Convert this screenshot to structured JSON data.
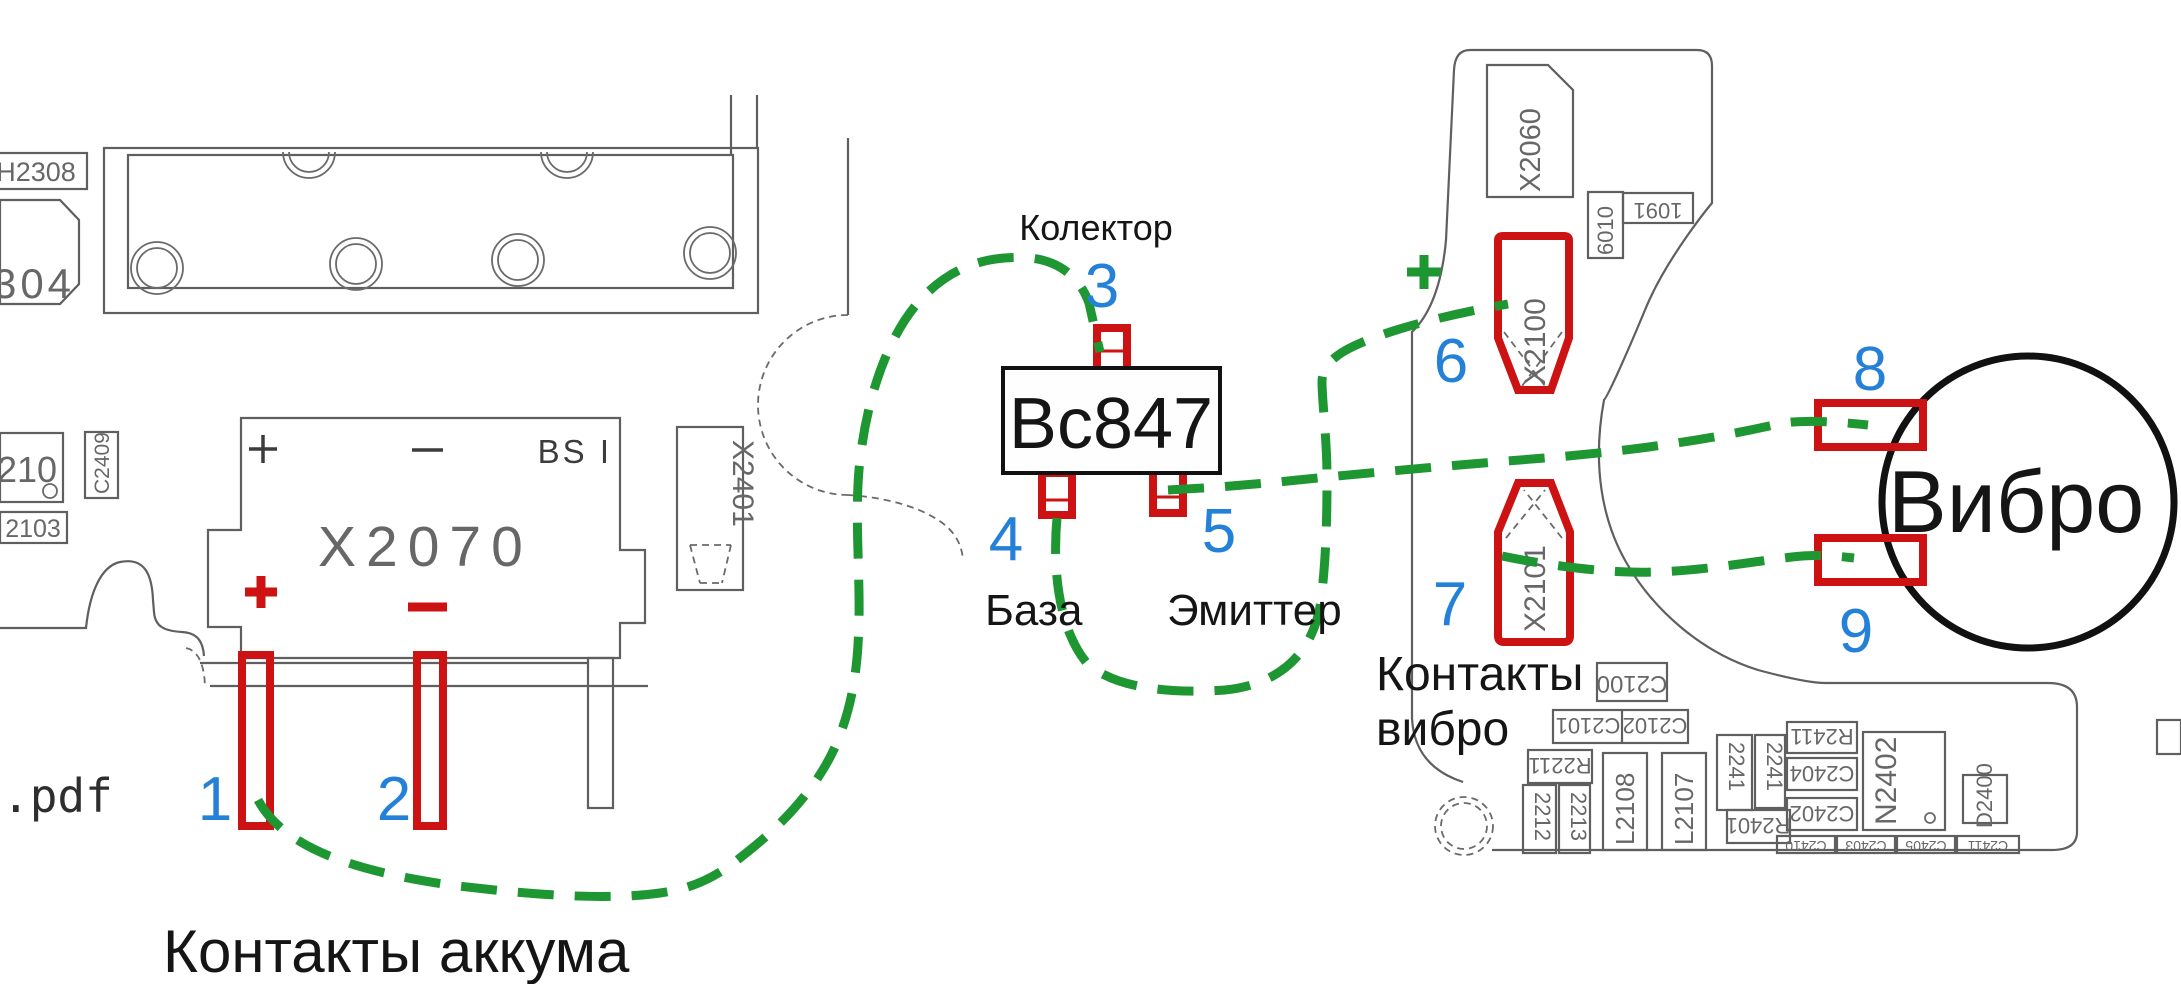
{
  "colors": {
    "red": "#cc1212",
    "green": "#1e9632",
    "blue": "#2581d8",
    "silkscreen_grey": "#676767",
    "black": "#151515"
  },
  "battery_area": {
    "caption": "Контакты аккума",
    "pdf_fragment": ".pdf",
    "connector": {
      "ref": "X2070",
      "plus_silk": "+",
      "minus_silk": "−",
      "bsi": "BS I"
    },
    "polarity": {
      "plus": "+",
      "minus": "−"
    },
    "pin1": "1",
    "pin2": "2",
    "nearby_refs": {
      "h2308": "H2308",
      "m304": "304",
      "r210": "210",
      "c2409": "C2409",
      "r2103": "2103",
      "x2401": "X2401"
    }
  },
  "transistor": {
    "ref": "Bc847",
    "collector": {
      "num": "3",
      "label": "Колектор"
    },
    "base": {
      "num": "4",
      "label": "База"
    },
    "emitter": {
      "num": "5",
      "label": "Эмиттер"
    }
  },
  "vibro_area": {
    "plus": "+",
    "pin6": "6",
    "pin7": "7",
    "pin8": "8",
    "pin9": "9",
    "caption_line1": "Контакты",
    "caption_line2": "вибро",
    "motor_label": "Вибро",
    "connectors": {
      "x2100": "X2100",
      "x2101": "X2101",
      "x2060": "X2060"
    },
    "silkscreen": {
      "l6010": "6010",
      "r1091": "1091",
      "c2100": "C2100",
      "c2101": "C2101",
      "c2102": "C2102",
      "r2211": "R2211",
      "cap_a": "2212",
      "cap_b": "2213",
      "l2108": "L2108",
      "l2107": "L2107",
      "cap_c": "2241",
      "cap_d": "2241",
      "r2401": "R2401",
      "r2411": "R2411",
      "c2404": "C2404",
      "c2402": "C2402",
      "n2402": "N2402",
      "d2400": "D2400",
      "c2410": "C2410",
      "c2403": "C2403",
      "c2405": "C2405",
      "c2411": "C2411"
    }
  }
}
